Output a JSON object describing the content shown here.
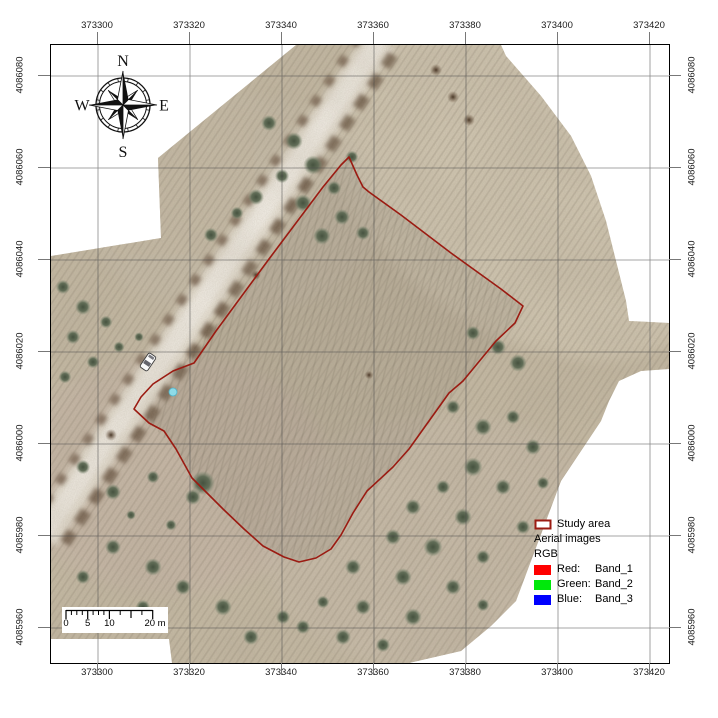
{
  "axes": {
    "x_labels": [
      "373300",
      "373320",
      "373340",
      "373360",
      "373380",
      "373400",
      "373420"
    ],
    "y_labels": [
      "4086080",
      "4086060",
      "4086040",
      "4086020",
      "4086000",
      "4085980",
      "4085960"
    ]
  },
  "compass": {
    "north": "N",
    "east": "E",
    "south": "S",
    "west": "W"
  },
  "scale_bar": {
    "tick_0": "0",
    "tick_5": "5",
    "tick_10": "10",
    "tick_20": "20 m"
  },
  "legend": {
    "study_area": {
      "label": "Study area",
      "outline_color": "#9b1b12",
      "fill_color": "#ffffff"
    },
    "layer_title": "Aerial images",
    "renderer_title": "RGB",
    "bands": [
      {
        "channel": "Red:",
        "band": "Band_1",
        "color": "#ff0000"
      },
      {
        "channel": "Green:",
        "band": "Band_2",
        "color": "#00e80b"
      },
      {
        "channel": "Blue:",
        "band": "Band_3",
        "color": "#0000ff"
      }
    ]
  },
  "map": {
    "study_area_outline_color": "#9b1b12"
  }
}
